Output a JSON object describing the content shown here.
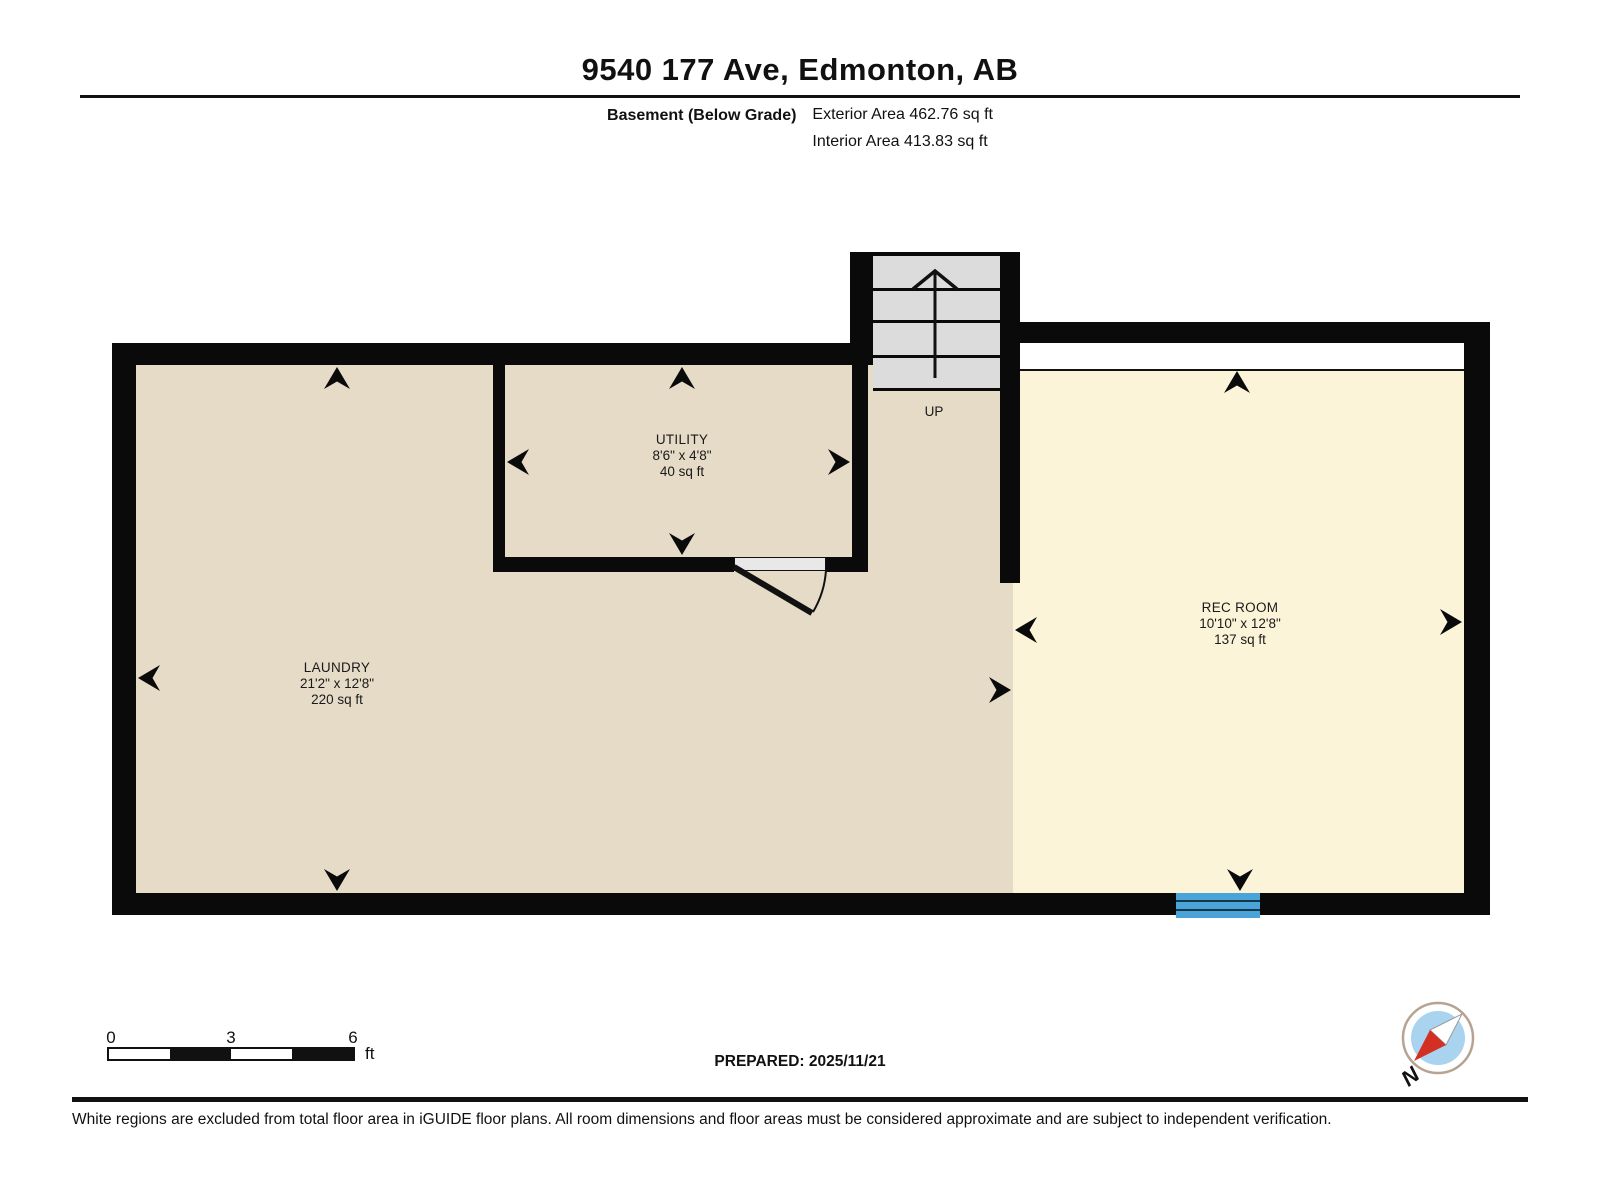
{
  "header": {
    "title": "9540 177 Ave, Edmonton, AB",
    "floor_label": "Basement (Below Grade)",
    "exterior_area": "Exterior Area 462.76 sq ft",
    "interior_area": "Interior Area 413.83 sq ft"
  },
  "rooms": [
    {
      "name": "UTILITY",
      "dimensions": "8'6\" x 4'8\"",
      "area": "40 sq ft"
    },
    {
      "name": "LAUNDRY",
      "dimensions": "21'2\" x 12'8\"",
      "area": "220 sq ft"
    },
    {
      "name": "REC ROOM",
      "dimensions": "10'10\" x 12'8\"",
      "area": "137 sq ft"
    }
  ],
  "stairs": {
    "label": "UP"
  },
  "scale_bar": {
    "ticks": [
      "0",
      "3",
      "6"
    ],
    "unit": "ft"
  },
  "footer": {
    "prepared": "PREPARED: 2025/11/21",
    "disclaimer": "White regions are excluded from total floor area in iGUIDE floor plans. All room dimensions and floor areas must be considered approximate and are subject to independent verification.",
    "compass_label": "N"
  },
  "colors": {
    "wall": "#0a0a0a",
    "room_fill_beige": "#e5dbc7",
    "room_fill_cream": "#fbf4d9",
    "stairs_fill": "#dcdcdc",
    "window_blue": "#4ba4d8",
    "compass_red": "#d32f23",
    "compass_blue": "#a9d3ee"
  }
}
